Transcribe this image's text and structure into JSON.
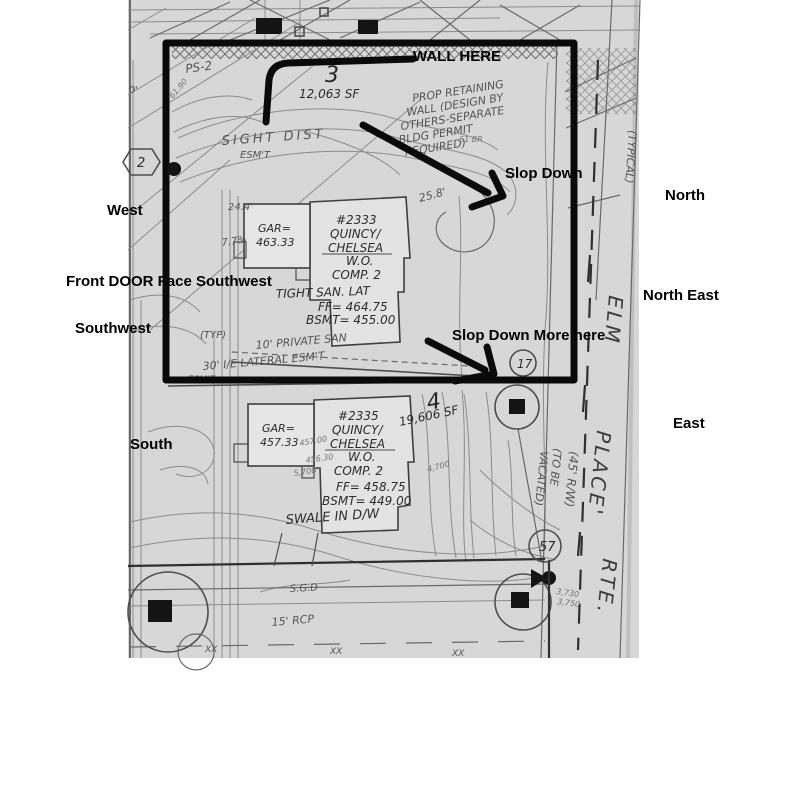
{
  "canvas": {
    "paper_color": "#d7d7d7",
    "overlay_color": "#000000"
  },
  "overlay_labels": {
    "wall_here": "WALL HERE",
    "slop_down": "Slop Down",
    "slop_down_more": "Slop Down More here",
    "front_door": "Front DOOR Face Southwest"
  },
  "compass": {
    "west": "West",
    "southwest": "Southwest",
    "south": "South",
    "north": "North",
    "north_east": "North East",
    "east": "East"
  },
  "lot3": {
    "number": "3",
    "area": "12,063 SF",
    "address": "#2333",
    "model_line1": "QUINCY/",
    "model_line2": "CHELSEA",
    "model_line3": "W.O.",
    "model_line4": "COMP. 2",
    "garage_line1": "GAR=",
    "garage_line2": "463.33",
    "san_note": "TIGHT SAN. LAT",
    "ff": "FF= 464.75",
    "bsmt": "BSMT= 455.00"
  },
  "lot4": {
    "number": "4",
    "area": "19,606 SF",
    "address": "#2335",
    "model_line1": "QUINCY/",
    "model_line2": "CHELSEA",
    "model_line3": "W.O.",
    "model_line4": "COMP. 2",
    "garage_line1": "GAR=",
    "garage_line2": "457.33",
    "ff": "FF= 458.75",
    "bsmt": "BSMT= 449.00",
    "swale": "SWALE IN D/W"
  },
  "plan_notes": {
    "ps2": "PS-2",
    "sight_dist": "SIGHT DIST",
    "sight_esmt": "ESM'T",
    "wall_note_l1": "PROP RETAINING",
    "wall_note_l2": "WALL (DESIGN BY",
    "wall_note_l3": "OTHERS-SEPARATE",
    "wall_note_l4": "BLDG PERMIT",
    "wall_note_l5": "REQUIRED)",
    "dim_25_8": "25.8'",
    "dim_24_4": "24.4'",
    "grade_7_7": "7.7%",
    "note_61br": "61 BR",
    "elev_6190": "61.90",
    "dim_0": "0'",
    "typ": "(TYP)",
    "private_san": "10' PRIVATE SAN",
    "lateral_esmt": "30' I/E LATERAL ESM'T",
    "esmt2": "ESM'T",
    "sgd": "S.G.D",
    "rcp": "15' RCP",
    "xx": "XX",
    "elev_457": "457.00",
    "elev_456": "456.30",
    "elev_5700": "5,700",
    "elev_4700": "4,700",
    "elev_3730": "3,730",
    "elev_3750": "3,750",
    "hex2": "2",
    "circle17": "17",
    "circle57": "57"
  },
  "street": {
    "elm": "ELM",
    "place": "PLACE'",
    "rte": "RTE.",
    "rw": "(45' R/W)",
    "vacated_l1": "(TO BE",
    "vacated_l2": "VACATED)",
    "typical": "(TYPICAL)"
  }
}
